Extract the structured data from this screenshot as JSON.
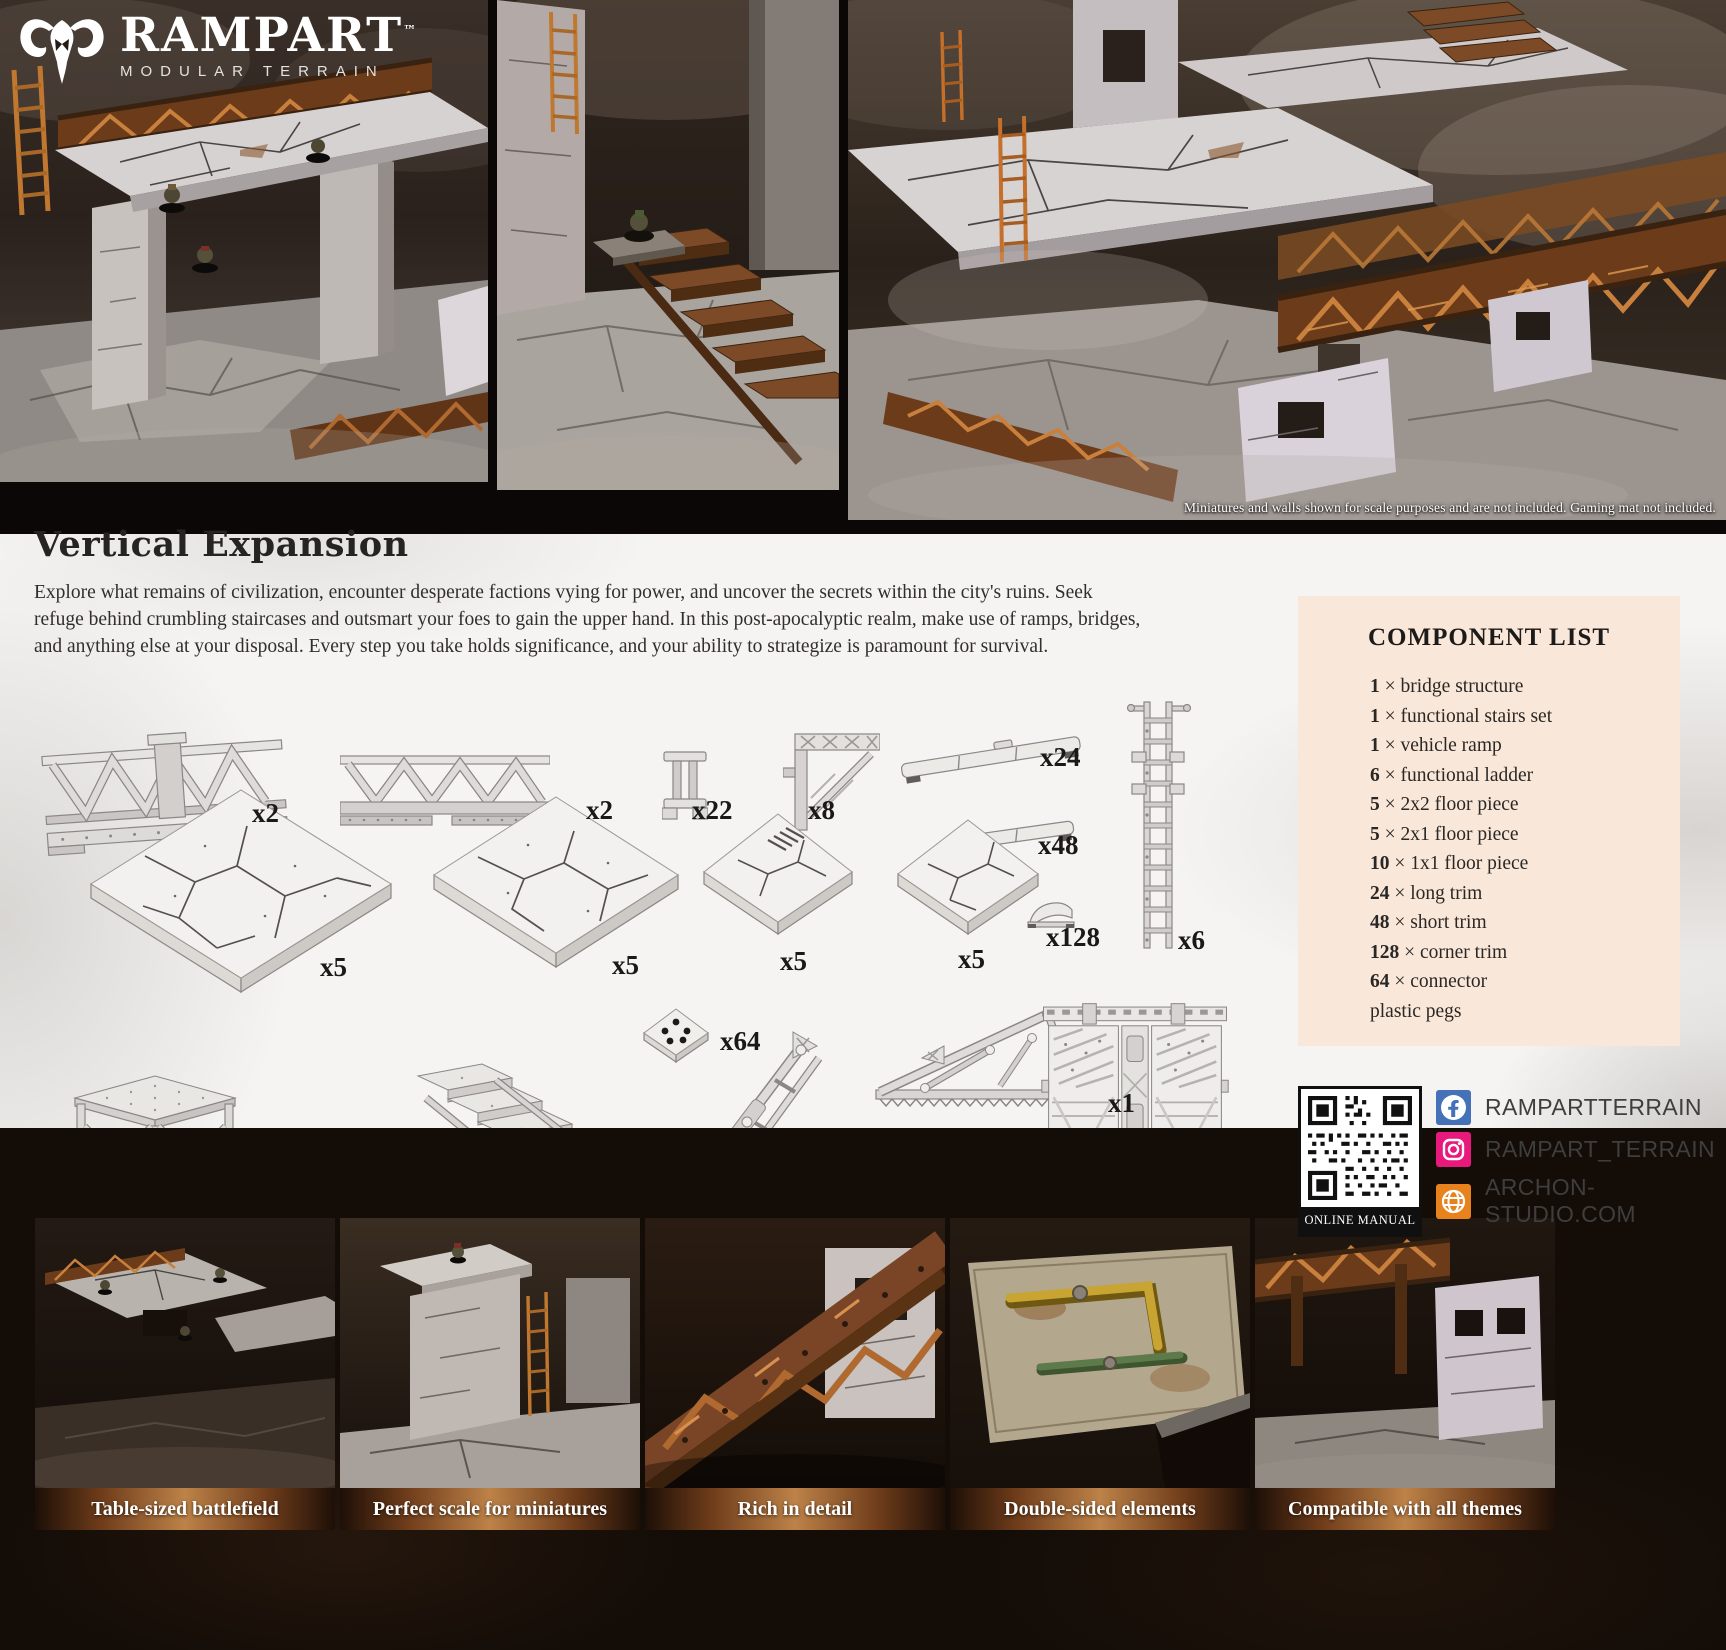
{
  "brand": {
    "name": "RAMPART",
    "trademark": "™",
    "tagline": "MODULAR TERRAIN"
  },
  "hero": {
    "disclaimer": "Miniatures and walls shown for scale purposes and are not included. Gaming mat not included."
  },
  "intro": {
    "title": "Vertical Expansion",
    "body": "Explore what remains of civilization, encounter desperate factions vying for power, and uncover the secrets within the city's ruins. Seek refuge behind crumbling staircases and outsmart your foes to gain the upper hand. In this post-apocalyptic realm, make use of ramps, bridges, and anything else at your disposal. Every step you take holds significance, and your ability to strategize is paramount for survival."
  },
  "components": [
    {
      "piece": "long bridge truss",
      "qty": "x2"
    },
    {
      "piece": "short bridge truss",
      "qty": "x2"
    },
    {
      "piece": "connector post",
      "qty": "x22"
    },
    {
      "piece": "corner bracket",
      "qty": "x8"
    },
    {
      "piece": "long trim",
      "qty": "x24"
    },
    {
      "piece": "short trim",
      "qty": "x48"
    },
    {
      "piece": "functional ladder",
      "qty": "x6"
    },
    {
      "piece": "2x2 floor piece",
      "qty": "x5"
    },
    {
      "piece": "2x1 floor piece",
      "qty": "x5"
    },
    {
      "piece": "1x1 floor piece",
      "qty": "x5"
    },
    {
      "piece": "1x1 floor piece",
      "qty": "x5"
    },
    {
      "piece": "corner trim",
      "qty": "x128"
    },
    {
      "piece": "connector plate",
      "qty": "x64"
    },
    {
      "piece": "support platform",
      "qty": "x2"
    },
    {
      "piece": "functional stairs",
      "qty": "x2"
    },
    {
      "piece": "folded ramp",
      "qty": "x1"
    },
    {
      "piece": "vehicle ramp",
      "qty": "x1"
    },
    {
      "piece": "bridge deck",
      "qty": "x1"
    }
  ],
  "component_list": {
    "title": "COMPONENT LIST",
    "times": "×",
    "items": [
      {
        "num": "1",
        "label": "bridge structure"
      },
      {
        "num": "1",
        "label": "functional stairs set"
      },
      {
        "num": "1",
        "label": "vehicle ramp"
      },
      {
        "num": "6",
        "label": "functional ladder"
      },
      {
        "num": "5",
        "label": "2x2 floor piece"
      },
      {
        "num": "5",
        "label": "2x1 floor piece"
      },
      {
        "num": "10",
        "label": "1x1 floor piece"
      },
      {
        "num": "24",
        "label": "long trim"
      },
      {
        "num": "48",
        "label": "short trim"
      },
      {
        "num": "128",
        "label": "corner trim"
      },
      {
        "num": "64",
        "label": "connector"
      },
      {
        "num": "",
        "label": "plastic pegs"
      }
    ]
  },
  "links": {
    "qr_label": "ONLINE MANUAL",
    "facebook": "RAMPARTTERRAIN",
    "instagram": "RAMPART_TERRAIN",
    "website": "ARCHON-STUDIO.COM"
  },
  "features": [
    {
      "caption": "Table-sized battlefield"
    },
    {
      "caption": "Perfect scale for miniatures"
    },
    {
      "caption": "Rich in detail"
    },
    {
      "caption": "Double-sided elements"
    },
    {
      "caption": "Compatible with all themes"
    }
  ],
  "colors": {
    "facebook_blue": "#4471b8",
    "instagram_pink": "#e8197d",
    "web_orange": "#e8821c",
    "panel_peach": "#f9e7d9",
    "caption_copper": "#bd8248"
  }
}
